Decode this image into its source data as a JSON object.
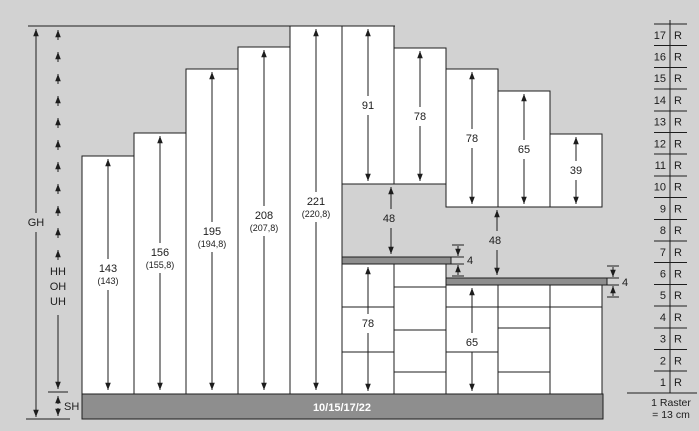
{
  "colors": {
    "background": "#d2d2d2",
    "surface": "#8e8e8e",
    "line": "#1d1d1d",
    "cabinet": "#ffffff",
    "plinth_text": "#ffffff"
  },
  "reference_labels": {
    "gh": "GH",
    "hh": "HH",
    "oh": "OH",
    "uh": "UH",
    "sh": "SH"
  },
  "tall_units": [
    {
      "label": "143",
      "sub": "(143)"
    },
    {
      "label": "156",
      "sub": "(155,8)"
    },
    {
      "label": "195",
      "sub": "(194,8)"
    },
    {
      "label": "208",
      "sub": "(207,8)"
    },
    {
      "label": "221",
      "sub": "(220,8)"
    }
  ],
  "wall_units": [
    {
      "label": "91"
    },
    {
      "label": "78"
    },
    {
      "label": "78"
    },
    {
      "label": "65"
    },
    {
      "label": "39"
    }
  ],
  "hang_gaps": [
    {
      "label": "48"
    },
    {
      "label": "48"
    }
  ],
  "worktops": [
    {
      "label": "4"
    },
    {
      "label": "4"
    }
  ],
  "base_units": [
    {
      "label": "78"
    },
    {
      "label": "65"
    }
  ],
  "plinth": {
    "label": "10/15/17/22"
  },
  "raster": {
    "rows": [
      {
        "num": "17",
        "unit": "R"
      },
      {
        "num": "16",
        "unit": "R"
      },
      {
        "num": "15",
        "unit": "R"
      },
      {
        "num": "14",
        "unit": "R"
      },
      {
        "num": "13",
        "unit": "R"
      },
      {
        "num": "12",
        "unit": "R"
      },
      {
        "num": "11",
        "unit": "R"
      },
      {
        "num": "10",
        "unit": "R"
      },
      {
        "num": "9",
        "unit": "R"
      },
      {
        "num": "8",
        "unit": "R"
      },
      {
        "num": "7",
        "unit": "R"
      },
      {
        "num": "6",
        "unit": "R"
      },
      {
        "num": "5",
        "unit": "R"
      },
      {
        "num": "4",
        "unit": "R"
      },
      {
        "num": "3",
        "unit": "R"
      },
      {
        "num": "2",
        "unit": "R"
      },
      {
        "num": "1",
        "unit": "R"
      }
    ],
    "legend_line1": "1 Raster",
    "legend_line2": "= 13 cm"
  }
}
